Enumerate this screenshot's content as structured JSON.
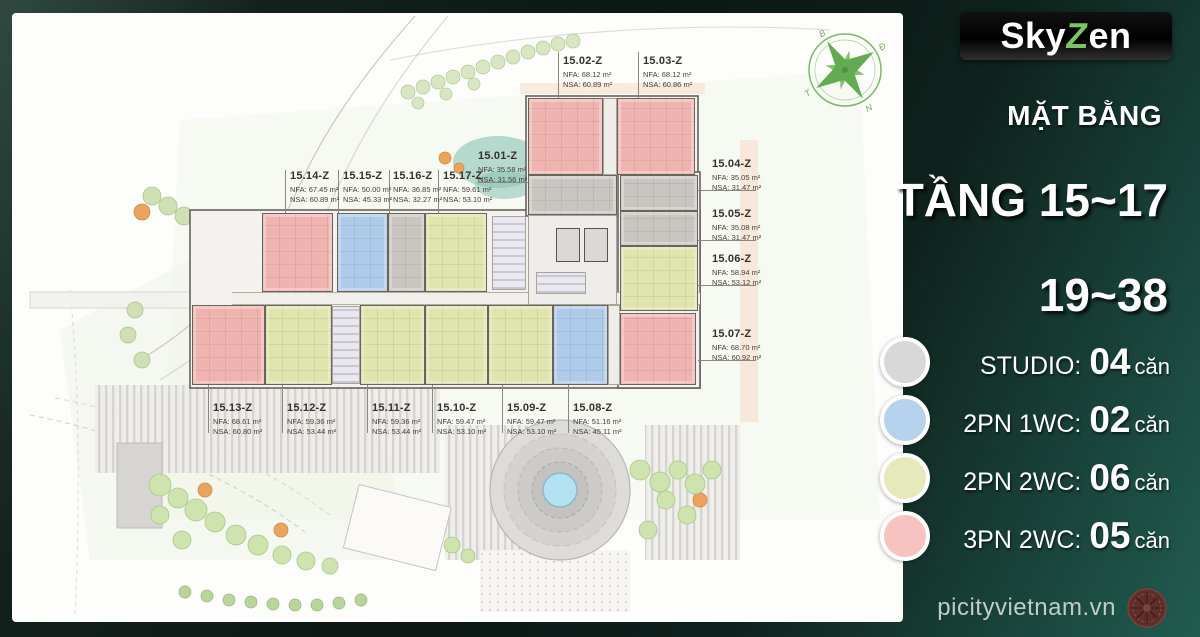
{
  "logo": {
    "part1": "Sky",
    "part2": "Z",
    "part3": "en"
  },
  "header": {
    "subtitle": "MẶT BẰNG",
    "floors_line1": "TẦNG 15~17",
    "floors_line2": "19~38"
  },
  "legend": {
    "items": [
      {
        "type_key": "STUDIO",
        "label": "STUDIO:",
        "count": "04",
        "unit_word": "căn",
        "color": "#d8d8d8"
      },
      {
        "type_key": "2PN1WC",
        "label": "2PN 1WC:",
        "count": "02",
        "unit_word": "căn",
        "color": "#b6d2ec"
      },
      {
        "type_key": "2PN2WC",
        "label": "2PN 2WC:",
        "count": "06",
        "unit_word": "căn",
        "color": "#e6e9bc"
      },
      {
        "type_key": "3PN2WC",
        "label": "3PN 2WC:",
        "count": "05",
        "unit_word": "căn",
        "color": "#f6c3c0"
      }
    ]
  },
  "footer": {
    "website": "picityvietnam.vn"
  },
  "compass": {
    "n": "B",
    "e": "Đ",
    "s": "N",
    "w": "T"
  },
  "floorplan": {
    "unit_colors": {
      "STUDIO": "#c9c6c2",
      "2PN1WC": "#aecbe9",
      "2PN2WC": "#dfe5ad",
      "3PN2WC": "#f0b4b0"
    },
    "units": [
      {
        "id": "15.02-Z",
        "type": "3PN2WC",
        "nfa": "NFA: 68.12 m²",
        "nsa": "NSA: 60.89 m²",
        "rect": [
          528,
          98,
          75,
          77
        ],
        "label": [
          563,
          55
        ],
        "leader": [
          558,
          52,
          1,
          46
        ]
      },
      {
        "id": "15.03-Z",
        "type": "3PN2WC",
        "nfa": "NFA: 68.12 m²",
        "nsa": "NSA: 60.86 m²",
        "rect": [
          617,
          98,
          78,
          77
        ],
        "label": [
          643,
          55
        ],
        "leader": [
          638,
          52,
          1,
          46
        ]
      },
      {
        "id": "15.01-Z",
        "type": "STUDIO",
        "nfa": "NFA: 35.58 m²",
        "nsa": "NSA: 31.56 m²",
        "rect": [
          528,
          175,
          89,
          40
        ],
        "label": [
          478,
          150
        ],
        "leader": [
          478,
          182,
          50,
          1
        ]
      },
      {
        "id": "15.04-Z",
        "type": "STUDIO",
        "nfa": "NFA: 35.05 m²",
        "nsa": "NSA: 31.47 m²",
        "rect": [
          620,
          175,
          78,
          36
        ],
        "label": [
          712,
          158
        ],
        "leader": [
          698,
          190,
          58,
          1
        ]
      },
      {
        "id": "15.05-Z",
        "type": "STUDIO",
        "nfa": "NFA: 35.08 m²",
        "nsa": "NSA: 31.47 m²",
        "rect": [
          620,
          211,
          78,
          35
        ],
        "label": [
          712,
          208
        ],
        "leader": [
          698,
          240,
          58,
          1
        ]
      },
      {
        "id": "15.06-Z",
        "type": "2PN2WC",
        "nfa": "NFA: 58.94 m²",
        "nsa": "NSA: 53.12 m²",
        "rect": [
          620,
          246,
          78,
          65
        ],
        "label": [
          712,
          253
        ],
        "leader": [
          698,
          285,
          58,
          1
        ]
      },
      {
        "id": "15.07-Z",
        "type": "3PN2WC",
        "nfa": "NFA: 68.70 m²",
        "nsa": "NSA: 60.92 m²",
        "rect": [
          620,
          313,
          76,
          72
        ],
        "label": [
          712,
          328
        ],
        "leader": [
          698,
          360,
          58,
          1
        ]
      },
      {
        "id": "15.08-Z",
        "type": "2PN1WC",
        "nfa": "NFA: 51.16 m²",
        "nsa": "NSA: 45.11 m²",
        "rect": [
          553,
          305,
          55,
          80
        ],
        "label": [
          573,
          402
        ],
        "leader": [
          568,
          385,
          1,
          48
        ]
      },
      {
        "id": "15.09-Z",
        "type": "2PN2WC",
        "nfa": "NFA: 59.47 m²",
        "nsa": "NSA: 53.10 m²",
        "rect": [
          488,
          305,
          65,
          80
        ],
        "label": [
          507,
          402
        ],
        "leader": [
          502,
          385,
          1,
          48
        ]
      },
      {
        "id": "15.10-Z",
        "type": "2PN2WC",
        "nfa": "NFA: 59.47 m²",
        "nsa": "NSA: 53.10 m²",
        "rect": [
          425,
          305,
          63,
          80
        ],
        "label": [
          437,
          402
        ],
        "leader": [
          432,
          385,
          1,
          48
        ]
      },
      {
        "id": "15.11-Z",
        "type": "2PN2WC",
        "nfa": "NFA: 59.36 m²",
        "nsa": "NSA: 53.44 m²",
        "rect": [
          360,
          305,
          65,
          80
        ],
        "label": [
          372,
          402
        ],
        "leader": [
          367,
          385,
          1,
          48
        ]
      },
      {
        "id": "15.12-Z",
        "type": "2PN2WC",
        "nfa": "NFA: 59.36 m²",
        "nsa": "NSA: 53.44 m²",
        "rect": [
          265,
          305,
          67,
          80
        ],
        "label": [
          287,
          402
        ],
        "leader": [
          282,
          385,
          1,
          48
        ]
      },
      {
        "id": "15.13-Z",
        "type": "3PN2WC",
        "nfa": "NFA: 68.61 m²",
        "nsa": "NSA: 60.80 m²",
        "rect": [
          192,
          305,
          73,
          80
        ],
        "label": [
          213,
          402
        ],
        "leader": [
          208,
          385,
          1,
          48
        ]
      },
      {
        "id": "15.14-Z",
        "type": "3PN2WC",
        "nfa": "NFA: 67.45 m²",
        "nsa": "NSA: 60.89 m²",
        "rect": [
          262,
          213,
          71,
          79
        ],
        "label": [
          290,
          170
        ],
        "leader": [
          285,
          170,
          1,
          43
        ]
      },
      {
        "id": "15.15-Z",
        "type": "2PN1WC",
        "nfa": "NFA: 50.00 m²",
        "nsa": "NSA: 45.33 m²",
        "rect": [
          337,
          213,
          51,
          79
        ],
        "label": [
          343,
          170
        ],
        "leader": [
          338,
          170,
          1,
          43
        ]
      },
      {
        "id": "15.16-Z",
        "type": "STUDIO",
        "nfa": "NFA: 36.85 m²",
        "nsa": "NSA: 32.27 m²",
        "rect": [
          388,
          213,
          37,
          79
        ],
        "label": [
          393,
          170
        ],
        "leader": [
          389,
          170,
          1,
          43
        ]
      },
      {
        "id": "15.17-Z",
        "type": "2PN2WC",
        "nfa": "NFA: 59.61 m²",
        "nsa": "NSA: 53.10 m²",
        "rect": [
          425,
          213,
          62,
          79
        ],
        "label": [
          443,
          170
        ],
        "leader": [
          438,
          170,
          1,
          43
        ]
      }
    ]
  }
}
